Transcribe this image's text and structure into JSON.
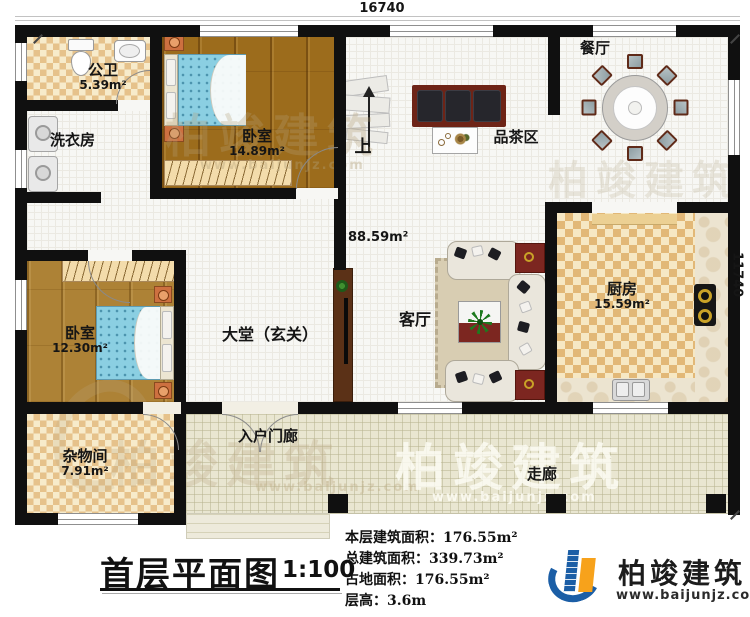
{
  "plan": {
    "title": "首层平面图",
    "scale": "1:100",
    "dimensions": {
      "top": "16740",
      "right": "11740"
    },
    "hall_area": "88.59m²",
    "stairs_label": "上",
    "rooms": {
      "bathroom": {
        "name": "公卫",
        "area": "5.39m²"
      },
      "laundry": {
        "name": "洗衣房"
      },
      "bedroom1": {
        "name": "卧室",
        "area": "14.89m²"
      },
      "dining": {
        "name": "餐厅"
      },
      "tea": {
        "name": "品茶区"
      },
      "kitchen": {
        "name": "厨房",
        "area": "15.59m²"
      },
      "living": {
        "name": "客厅"
      },
      "hall": {
        "name": "大堂（玄关）"
      },
      "bedroom2": {
        "name": "卧室",
        "area": "12.30m²"
      },
      "storage": {
        "name": "杂物间",
        "area": "7.91m²"
      },
      "porch": {
        "name": "入户门廊"
      },
      "corridor": {
        "name": "走廊"
      }
    }
  },
  "stats": {
    "lines": [
      "本层建筑面积：176.55m²",
      "总建筑面积：339.73m²",
      "占地面积：176.55m²",
      "层高：3.6m"
    ]
  },
  "brand": {
    "name": "柏竣建筑",
    "url": "www.baijunjz.com"
  },
  "watermark": {
    "text": "柏竣建筑",
    "url": "www.baijunjz.com"
  },
  "colors": {
    "wall": "#101010",
    "wood": "#9c6c1c",
    "checker": "#e2b877",
    "bed_blue": "#8bcfe2",
    "accent_red": "#7c2620",
    "logo_blue": "#1b5ea6",
    "logo_orange": "#f7a21b"
  }
}
